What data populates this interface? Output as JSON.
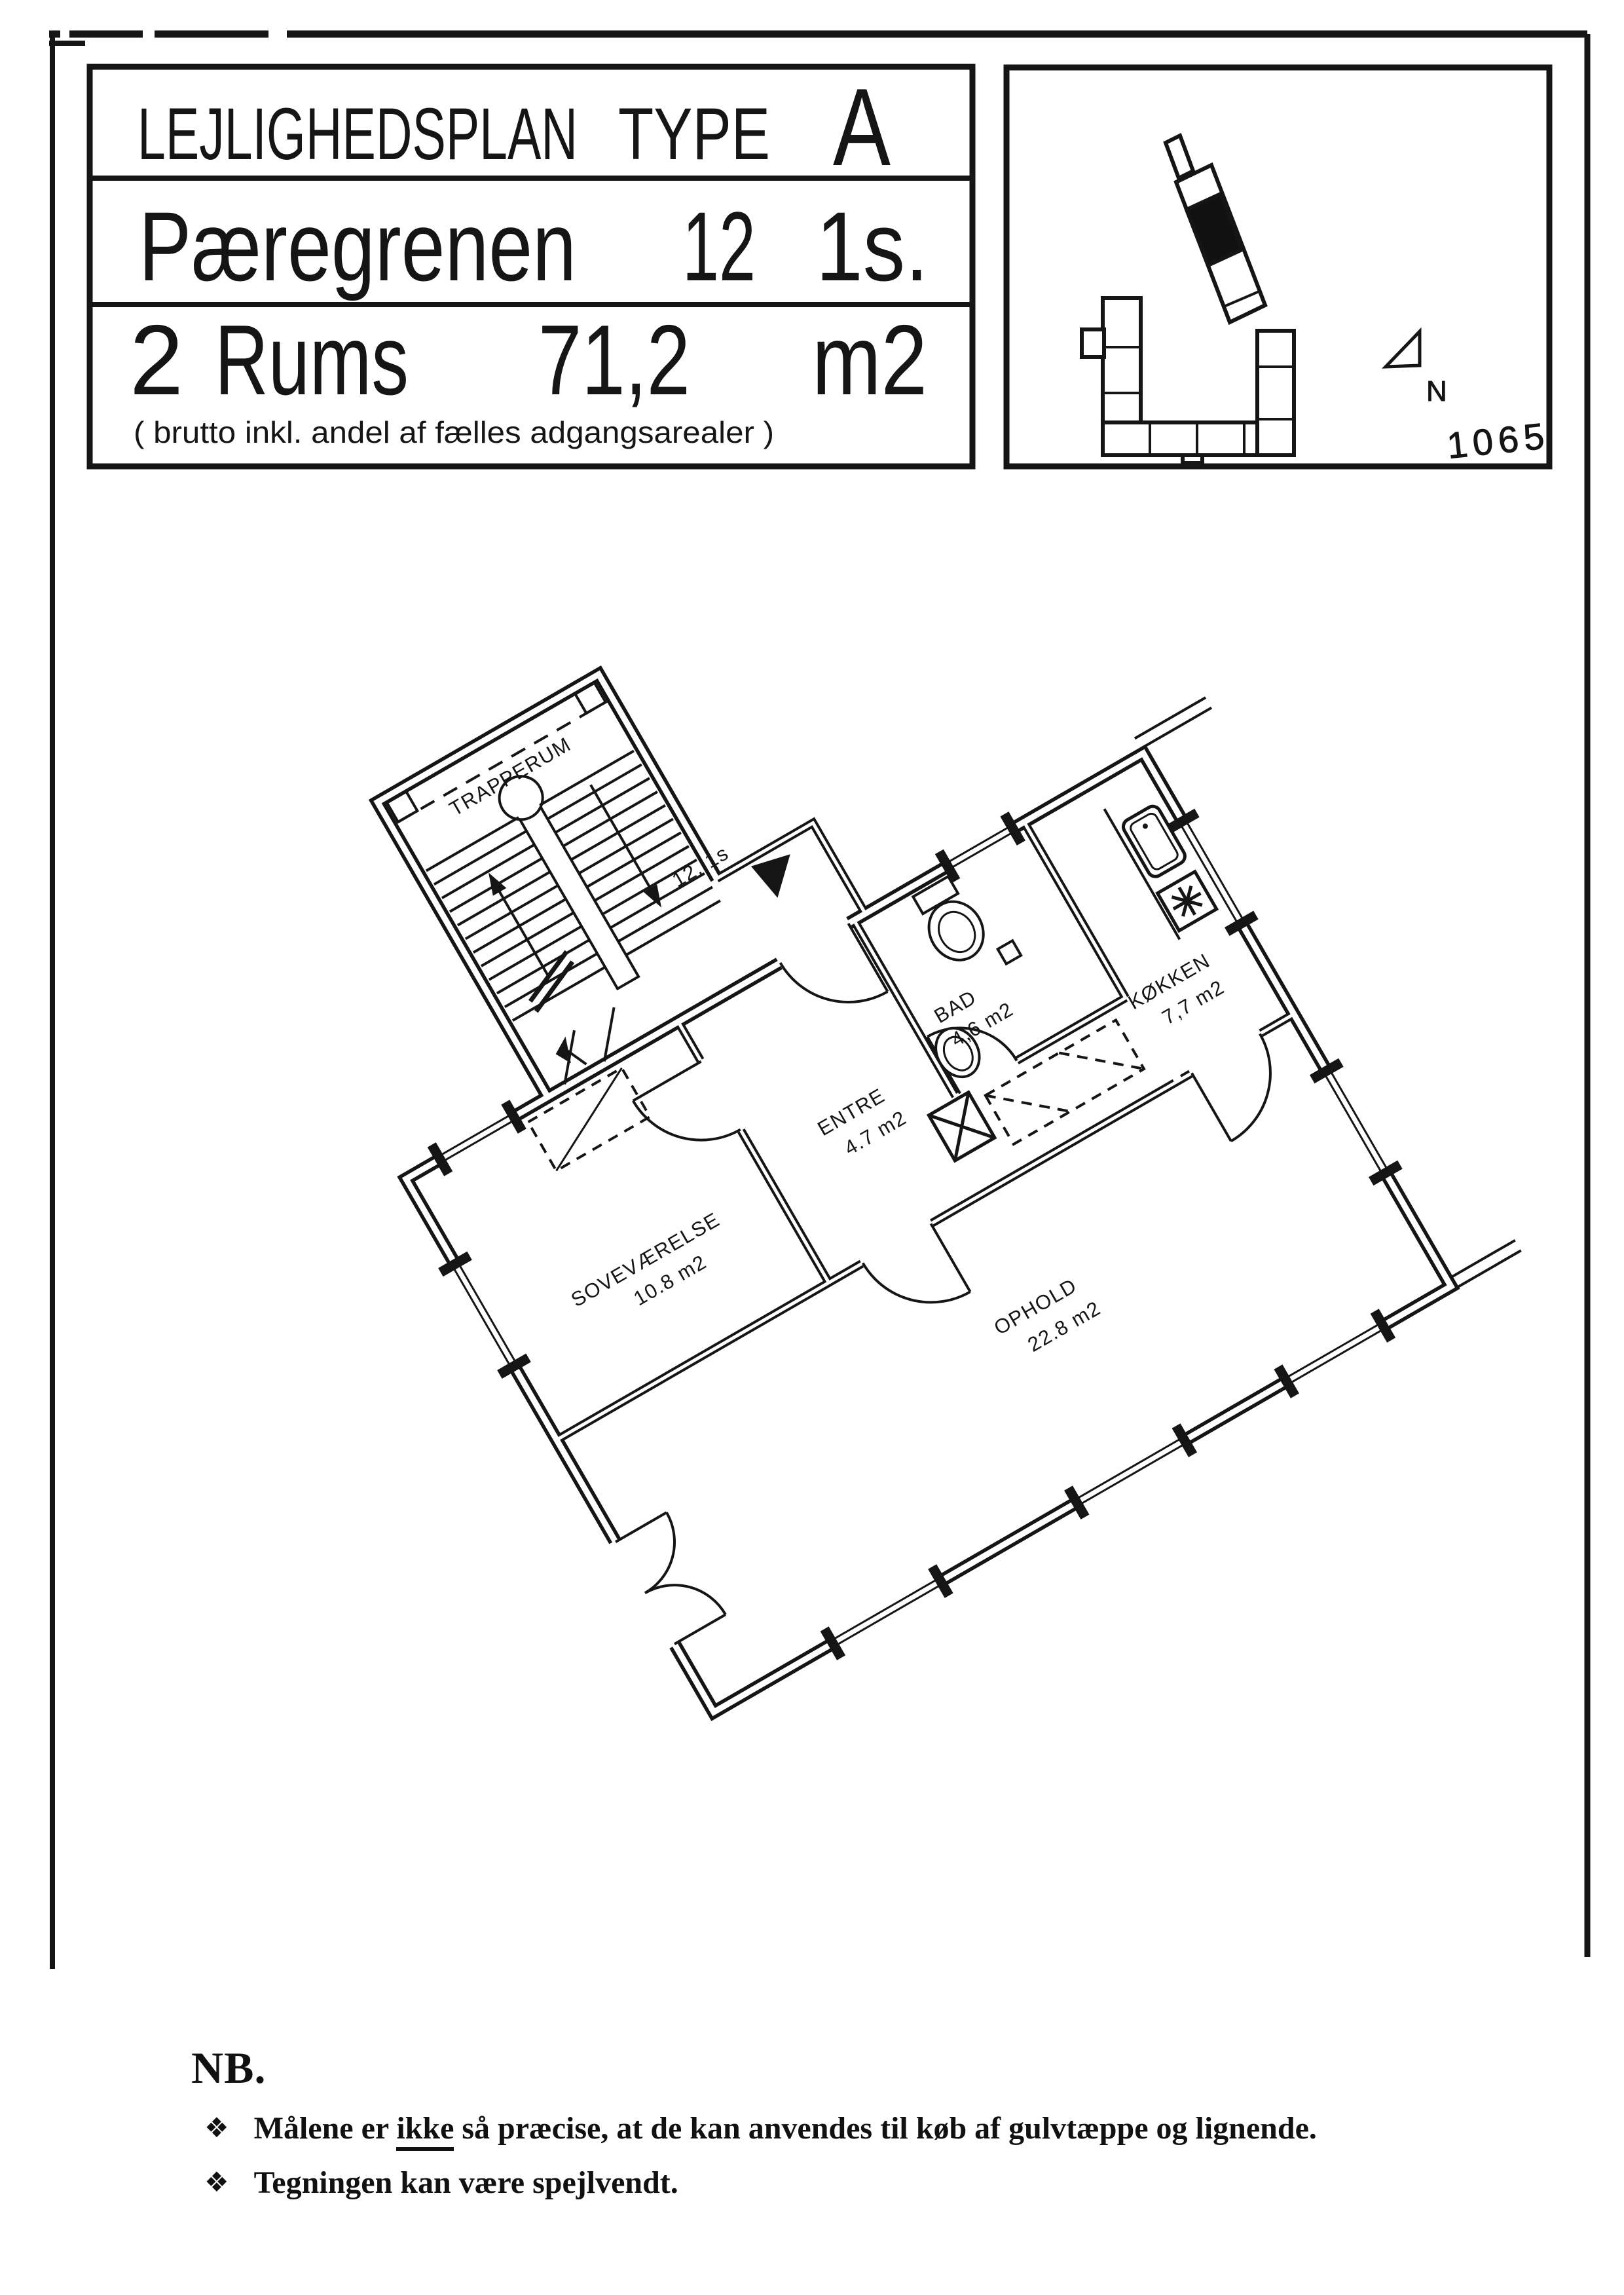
{
  "title_block": {
    "heading_word1": "LEJLIGHEDSPLAN",
    "heading_word2": "TYPE",
    "type_letter": "A",
    "street": "Pæregrenen",
    "number": "12",
    "floor": "1s.",
    "rooms_count": "2",
    "rooms_word": "Rums",
    "area": "71,2",
    "area_unit": "m2",
    "brutto_note": "( brutto inkl. andel af fælles adgangsarealer )"
  },
  "site_map": {
    "north_label": "N",
    "faint_note": "1065"
  },
  "floor_plan": {
    "stairwell_label": "TRAPPERUM",
    "unit_marker": "12. 1s",
    "rooms": [
      {
        "name": "SOVEVÆRELSE",
        "area": "10.8 m2"
      },
      {
        "name": "ENTRE",
        "area": "4.7 m2"
      },
      {
        "name": "BAD",
        "area": "4,6 m2"
      },
      {
        "name": "KØKKEN",
        "area": "7,7 m2"
      },
      {
        "name": "OPHOLD",
        "area": "22.8 m2"
      }
    ]
  },
  "notes": {
    "heading": "NB.",
    "bullet_glyph": "❖",
    "items": [
      {
        "pre": "Målene er ",
        "underlined": "ikke",
        "post": " så præcise, at de kan anvendes til køb af gulvtæppe og lignende."
      },
      {
        "pre": "",
        "underlined": "",
        "post": "Tegningen kan være spejlvendt."
      }
    ]
  },
  "colors": {
    "ink": "#151515",
    "paper": "#ffffff",
    "faint_pencil": "#c0c0c0"
  }
}
